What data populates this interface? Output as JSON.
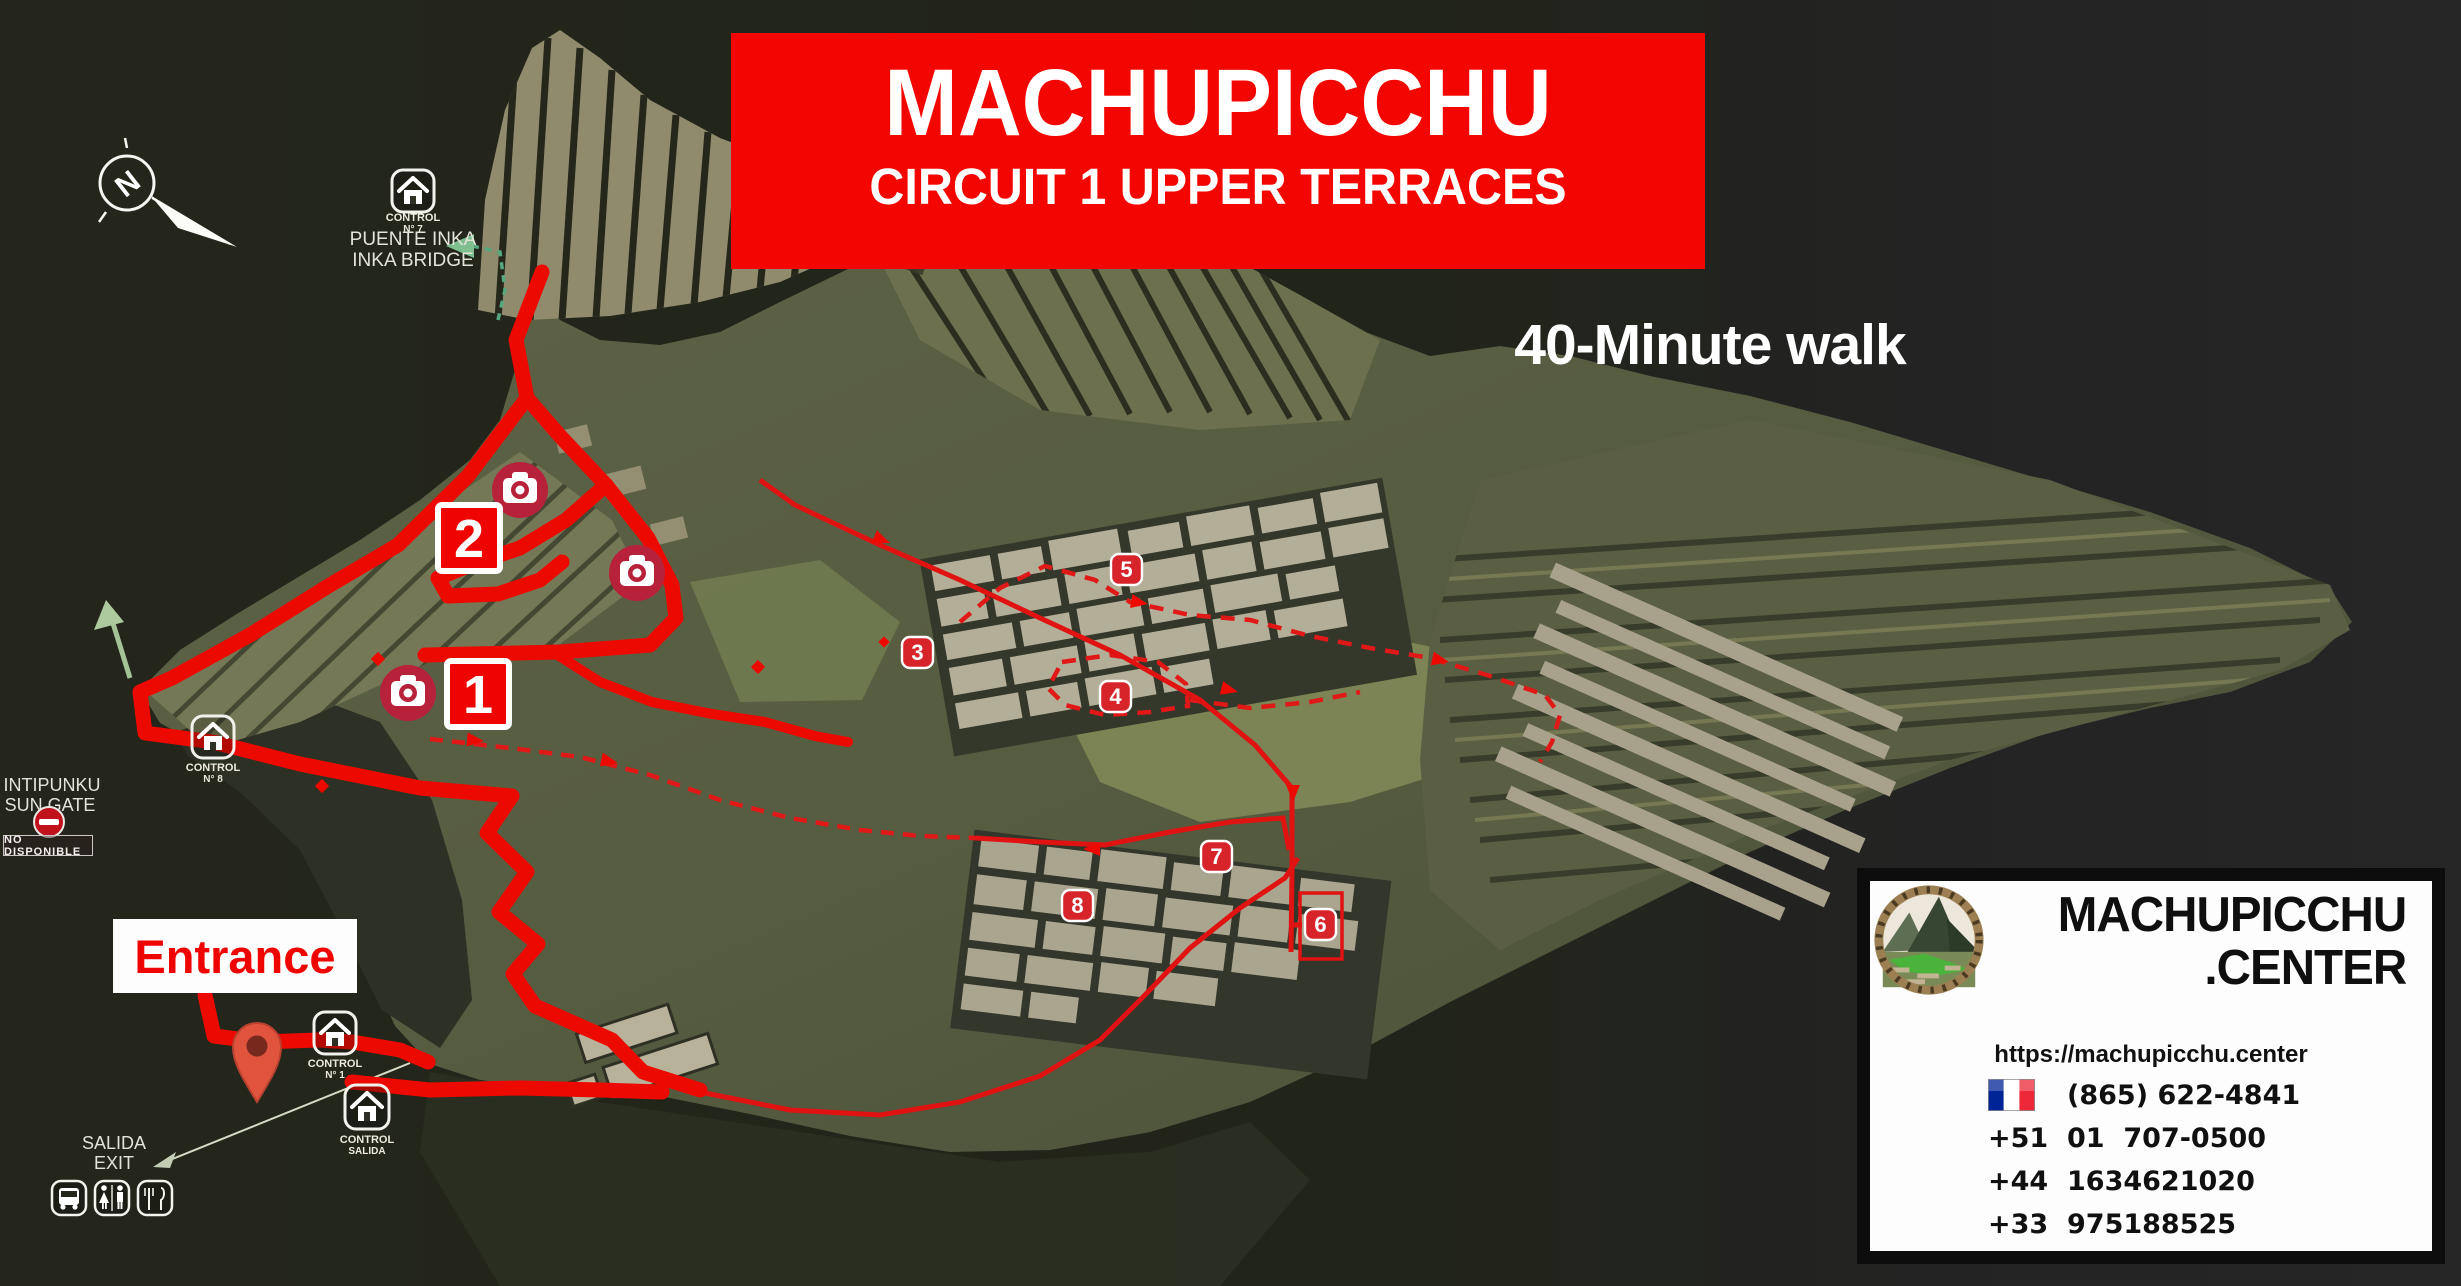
{
  "title": {
    "line1": "MACHUPICCHU",
    "line2": "CIRCUIT 1 UPPER TERRACES"
  },
  "walk_time": "40-Minute walk",
  "map": {
    "compass_letter": "N",
    "puente_inka": {
      "control": "CONTROL",
      "control_no": "N° 7",
      "line1": "PUENTE INKA",
      "line2": "INKA BRIDGE"
    },
    "intipunku": {
      "line1": "INTIPUNKU",
      "line2": "SUN GATE",
      "badge": "NO DISPONIBLE"
    },
    "control_8": {
      "control": "CONTROL",
      "control_no": "N° 8"
    },
    "control_1": {
      "control": "CONTROL",
      "control_no": "N° 1"
    },
    "control_salida": {
      "control": "CONTROL",
      "control_no": "SALIDA"
    },
    "entrance_label": "Entrance",
    "salida": {
      "line1": "SALIDA",
      "line2": "EXIT"
    },
    "stops": [
      "1",
      "2",
      "3",
      "4",
      "5",
      "6",
      "7",
      "8"
    ]
  },
  "info_box": {
    "brand_line1": "MACHUPICCHU",
    "brand_line2": ".CENTER",
    "website": "https://machupicchu.center",
    "phones": [
      {
        "flag": "us-flag",
        "number": "+1    (865) 622-4841"
      },
      {
        "flag": "peru-flag",
        "number": "+51  01  707-0500"
      },
      {
        "flag": "uk-flag",
        "number": "+44  1634621020"
      },
      {
        "flag": "france-flag",
        "number": "+33  975188525"
      }
    ]
  },
  "colors": {
    "route_red": "#ec0a00",
    "banner_red": "#f30600",
    "marker_red": "#d7242b",
    "camera_red": "#b72137",
    "terrain_green": "#5d6246"
  }
}
